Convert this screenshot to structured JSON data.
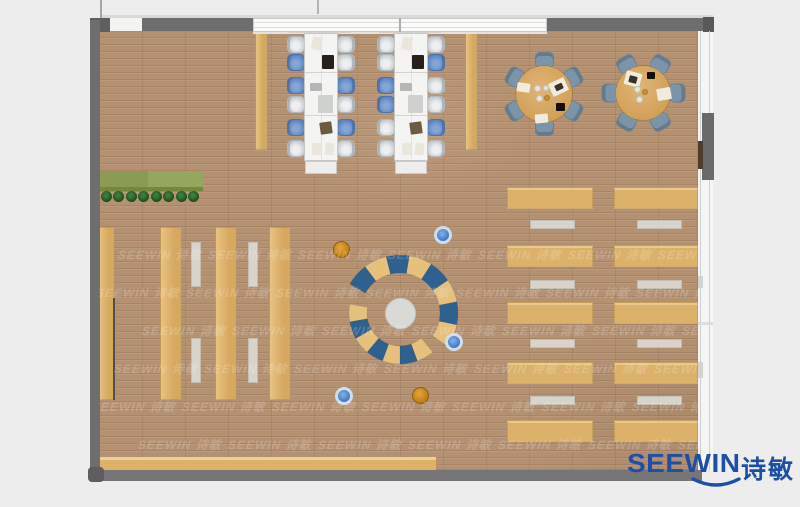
{
  "logo": {
    "latin": "SEEWIN",
    "cn": "诗敏",
    "color": "#1d4fa6"
  },
  "watermark": {
    "text": "SEEWIN 诗敏",
    "opacity": 0.42,
    "step": 90,
    "rows": [
      {
        "y": 246,
        "x0": 118
      },
      {
        "y": 284,
        "x0": 96
      },
      {
        "y": 322,
        "x0": 142
      },
      {
        "y": 360,
        "x0": 114
      },
      {
        "y": 398,
        "x0": 92
      },
      {
        "y": 436,
        "x0": 138
      }
    ]
  },
  "colors": {
    "wall": "#6e6e6e",
    "wall_dark": "#5f5f5f",
    "wall_bottom": "#767676",
    "seg_t": "#e6c07d",
    "seg_b": "#2e6190",
    "chair_gray": "#c9ced2",
    "chair_blue": "#5e87c2",
    "dining_chair": "#7b93a7",
    "table_tan": "#dcb26a",
    "logo_blue": "#1d4fa6"
  },
  "scene": {
    "room": {
      "x": 99,
      "y": 31,
      "w": 599,
      "h": 439
    },
    "rects": [
      {
        "n": "top-outer-line",
        "x": 100,
        "y": 15,
        "w": 613,
        "h": 3,
        "f": "#d9d9d9",
        "z": 40
      },
      {
        "n": "roof-line-1",
        "x": 100,
        "y": 0,
        "w": 2,
        "h": 18,
        "f": "#a5a5a5",
        "z": 40
      },
      {
        "n": "roof-line-2",
        "x": 317,
        "y": 0,
        "w": 2,
        "h": 14,
        "f": "#b3b3b3",
        "z": 40
      },
      {
        "n": "top-wall-cap-left",
        "x": 90,
        "y": 18,
        "w": 20,
        "h": 14,
        "f": "#5f5f5f",
        "z": 41
      },
      {
        "n": "door-gap-top",
        "x": 110,
        "y": 18,
        "w": 32,
        "h": 13,
        "f": "#f3f3f1",
        "z": 40
      },
      {
        "n": "top-wall-left",
        "x": 142,
        "y": 18,
        "w": 111,
        "h": 13,
        "f": "#6e6e6e",
        "z": 41
      },
      {
        "n": "window-band-top",
        "x": 253,
        "y": 18,
        "w": 294,
        "h": 14,
        "f": "#fbfbfa",
        "b": "1px solid #c9c9c9",
        "z": 40
      },
      {
        "n": "window-band-line1",
        "x": 253,
        "y": 22,
        "w": 294,
        "h": 1,
        "f": "#dddddc",
        "z": 41
      },
      {
        "n": "window-band-line2",
        "x": 253,
        "y": 27,
        "w": 294,
        "h": 1,
        "f": "#dddddc",
        "z": 41
      },
      {
        "n": "window-mullion",
        "x": 399,
        "y": 18,
        "w": 2,
        "h": 14,
        "f": "#ababab",
        "z": 42
      },
      {
        "n": "top-wall-right",
        "x": 547,
        "y": 18,
        "w": 156,
        "h": 13,
        "f": "#6e6e6e",
        "z": 41
      },
      {
        "n": "top-wall-cap-right",
        "x": 703,
        "y": 17,
        "w": 11,
        "h": 15,
        "f": "#595959",
        "z": 41
      },
      {
        "n": "left-wall",
        "x": 90,
        "y": 20,
        "w": 10,
        "h": 450,
        "f": "#6e6e6e",
        "z": 41
      },
      {
        "n": "bottom-wall",
        "x": 90,
        "y": 470,
        "w": 612,
        "h": 11,
        "f": "#767676",
        "z": 40
      },
      {
        "n": "corner-cap-bottom-left",
        "x": 88,
        "y": 467,
        "w": 16,
        "h": 15,
        "f": "#5e5e5e",
        "r": 4,
        "z": 41
      },
      {
        "n": "window-sill-top",
        "x": 253,
        "y": 31,
        "w": 294,
        "h": 3,
        "f": "#e3e2df",
        "z": 11
      },
      {
        "n": "right-window-wall",
        "x": 698,
        "y": 31,
        "w": 15,
        "h": 439,
        "f": "#f5f5f4",
        "z": 40
      },
      {
        "n": "right-window-line1",
        "x": 700,
        "y": 31,
        "w": 1,
        "h": 439,
        "f": "#cfcfcf",
        "z": 41
      },
      {
        "n": "right-window-line2",
        "x": 709,
        "y": 31,
        "w": 1,
        "h": 439,
        "f": "#cfcfcf",
        "z": 41
      },
      {
        "n": "right-wall-solid",
        "x": 702,
        "y": 113,
        "w": 12,
        "h": 67,
        "f": "#6a6a6a",
        "z": 42
      },
      {
        "n": "right-wall-door",
        "x": 698,
        "y": 141,
        "w": 5,
        "h": 28,
        "f": "#4e3d2c",
        "z": 43
      },
      {
        "n": "right-window-tab1",
        "x": 698,
        "y": 276,
        "w": 5,
        "h": 12,
        "f": "#d3d3d0",
        "z": 42
      },
      {
        "n": "right-window-tab2",
        "x": 698,
        "y": 362,
        "w": 5,
        "h": 16,
        "f": "#d3d3d0",
        "z": 42
      },
      {
        "n": "right-window-mullion1",
        "x": 698,
        "y": 322,
        "w": 15,
        "h": 3,
        "f": "#dcdcda",
        "z": 42
      },
      {
        "n": "planter-left",
        "x": 100,
        "y": 171,
        "w": 48,
        "h": 16,
        "f": "#8b9c52",
        "z": 10
      },
      {
        "n": "planter-right",
        "x": 148,
        "y": 171,
        "w": 55,
        "h": 16,
        "f": "#96a65c",
        "z": 10
      },
      {
        "n": "planter-shadow",
        "x": 100,
        "y": 187,
        "w": 103,
        "h": 4,
        "f": "#75863e",
        "z": 10
      },
      {
        "n": "book-stack-1",
        "x": 98,
        "y": 227,
        "w": 16,
        "h": 173,
        "f": "tan",
        "z": 10
      },
      {
        "n": "book-stack-2",
        "x": 160,
        "y": 227,
        "w": 21,
        "h": 173,
        "f": "tan",
        "z": 10
      },
      {
        "n": "book-stack-3",
        "x": 215,
        "y": 227,
        "w": 21,
        "h": 173,
        "f": "tan",
        "z": 10
      },
      {
        "n": "book-stack-4",
        "x": 269,
        "y": 227,
        "w": 21,
        "h": 173,
        "f": "tan",
        "z": 10
      },
      {
        "n": "stack-shadow-edge",
        "x": 113,
        "y": 298,
        "w": 2,
        "h": 102,
        "f": "#4f4f4f",
        "z": 11
      },
      {
        "n": "stack-bench-1a",
        "x": 191,
        "y": 242,
        "w": 10,
        "h": 45,
        "f": "bench",
        "z": 10
      },
      {
        "n": "stack-bench-1b",
        "x": 191,
        "y": 338,
        "w": 10,
        "h": 45,
        "f": "bench",
        "z": 10
      },
      {
        "n": "stack-bench-2a",
        "x": 248,
        "y": 242,
        "w": 10,
        "h": 45,
        "f": "bench",
        "z": 10
      },
      {
        "n": "stack-bench-2b",
        "x": 248,
        "y": 338,
        "w": 10,
        "h": 45,
        "f": "bench",
        "z": 10
      },
      {
        "n": "screen-panel-1",
        "x": 255,
        "y": 33,
        "w": 12,
        "h": 117,
        "f": "tan",
        "z": 10
      },
      {
        "n": "screen-panel-2",
        "x": 465,
        "y": 33,
        "w": 12,
        "h": 117,
        "f": "tan",
        "z": 10
      },
      {
        "n": "service-counter",
        "x": 99,
        "y": 457,
        "w": 338,
        "h": 13,
        "f": "counter",
        "z": 12
      },
      {
        "n": "ws-wall-panel-1",
        "x": 289,
        "y": 28,
        "w": 62,
        "h": 5,
        "f": "#d2d2d0",
        "z": 12
      },
      {
        "n": "ws-wall-panel-2",
        "x": 379,
        "y": 28,
        "w": 62,
        "h": 5,
        "f": "#d2d2d0",
        "z": 12
      }
    ],
    "trees": {
      "y": 196,
      "r": 5.5,
      "xs": [
        106,
        118.5,
        131,
        143.5,
        156,
        168.5,
        181,
        193.5
      ]
    },
    "workstations": {
      "desk_y": 33,
      "desk_h": 128,
      "desk_w": 34,
      "chair_ys": [
        36,
        54,
        77,
        96,
        119,
        140
      ],
      "groups": [
        {
          "x": 304,
          "left": [
            "g",
            "b",
            "b",
            "g",
            "b",
            "g"
          ],
          "right": [
            "g",
            "g",
            "b",
            "g",
            "b",
            "g"
          ]
        },
        {
          "x": 394,
          "left": [
            "g",
            "g",
            "b",
            "b",
            "g",
            "g"
          ],
          "right": [
            "g",
            "b",
            "g",
            "g",
            "b",
            "g"
          ]
        }
      ],
      "items": [
        {
          "dx": 8,
          "dy": 4,
          "w": 10,
          "h": 13,
          "f": "#eae6db",
          "rot": 12
        },
        {
          "dx": 18,
          "dy": 22,
          "w": 12,
          "h": 14,
          "f": "#27201a",
          "rot": 0
        },
        {
          "dx": 6,
          "dy": 50,
          "w": 12,
          "h": 8,
          "f": "#b4b8b4",
          "rot": 0
        },
        {
          "dx": 14,
          "dy": 62,
          "w": 15,
          "h": 18,
          "f": "#ced1ce",
          "rot": 0
        },
        {
          "dx": 16,
          "dy": 89,
          "w": 12,
          "h": 12,
          "f": "#6b5b41",
          "rot": -8
        },
        {
          "dx": 8,
          "dy": 110,
          "w": 9,
          "h": 12,
          "f": "#eae6db",
          "rot": 0
        },
        {
          "dx": 21,
          "dy": 110,
          "w": 9,
          "h": 12,
          "f": "#eae6db",
          "rot": 6
        }
      ]
    },
    "round_tables": [
      {
        "cx": 544,
        "cy": 94,
        "r": 28,
        "angles": [
          90,
          150,
          210,
          270,
          330,
          30
        ],
        "items": [
          {
            "t": "r",
            "x": 550,
            "y": 80,
            "w": 17,
            "h": 14,
            "f": "#efecdf",
            "rot": -25
          },
          {
            "t": "r",
            "x": 555,
            "y": 84,
            "w": 8,
            "h": 6,
            "f": "#3a3226",
            "rot": -25
          },
          {
            "t": "r",
            "x": 517,
            "y": 83,
            "w": 13,
            "h": 9,
            "f": "#efecdf",
            "rot": 8
          },
          {
            "t": "c",
            "x": 537,
            "y": 88,
            "r": 3.5,
            "f": "#e7e4d8"
          },
          {
            "t": "c",
            "x": 546,
            "y": 88,
            "r": 3,
            "f": "#e7e4d8"
          },
          {
            "t": "c",
            "x": 539,
            "y": 98,
            "r": 3.5,
            "f": "#e7e4d8"
          },
          {
            "t": "c",
            "x": 547,
            "y": 98,
            "r": 3,
            "f": "#c98f2f"
          },
          {
            "t": "r",
            "x": 556,
            "y": 103,
            "w": 9,
            "h": 8,
            "f": "#150e08",
            "rot": 0
          },
          {
            "t": "r",
            "x": 535,
            "y": 114,
            "w": 13,
            "h": 9,
            "f": "#efecdf",
            "rot": -5
          }
        ]
      },
      {
        "cx": 643,
        "cy": 93,
        "r": 27,
        "angles": [
          0,
          60,
          120,
          180,
          240,
          300
        ],
        "items": [
          {
            "t": "r",
            "x": 625,
            "y": 72,
            "w": 16,
            "h": 14,
            "f": "#efecdf",
            "rot": 15
          },
          {
            "t": "r",
            "x": 629,
            "y": 76,
            "w": 8,
            "h": 7,
            "f": "#3a3226",
            "rot": 15
          },
          {
            "t": "r",
            "x": 647,
            "y": 72,
            "w": 8,
            "h": 7,
            "f": "#150e08",
            "rot": 0
          },
          {
            "t": "c",
            "x": 637,
            "y": 89,
            "r": 3.5,
            "f": "#e7e4d8"
          },
          {
            "t": "c",
            "x": 645,
            "y": 92,
            "r": 3,
            "f": "#c98f2f"
          },
          {
            "t": "c",
            "x": 639,
            "y": 99,
            "r": 3.5,
            "f": "#e7e4d8"
          },
          {
            "t": "r",
            "x": 657,
            "y": 88,
            "w": 14,
            "h": 12,
            "f": "#efecdf",
            "rot": -10
          }
        ]
      }
    ],
    "reading": {
      "cols": [
        {
          "tx": 507,
          "tw": 86,
          "bx": 530
        },
        {
          "tx": 614,
          "tw": 84,
          "bx": 637
        }
      ],
      "rows": [
        187,
        245,
        302,
        362,
        420
      ],
      "th": 22,
      "bench_rows": [
        220,
        280,
        339,
        396
      ],
      "bw": 45,
      "bh": 9
    },
    "lounge": {
      "cx": 400,
      "cy": 313,
      "core_r": 15.5,
      "arcs": [
        {
          "r_in": 33,
          "r_out": 51,
          "from": 170,
          "to": 310,
          "seq": [
            "t",
            "b",
            "t",
            "b",
            "t",
            "b",
            "t"
          ]
        },
        {
          "r_in": 40,
          "r_out": 58,
          "from": 150,
          "to": -35,
          "seq": [
            "b",
            "t",
            "b",
            "t",
            "b",
            "t",
            "b",
            "t"
          ]
        }
      ],
      "stools": [
        {
          "x": 443,
          "y": 235,
          "c": "blue"
        },
        {
          "x": 342,
          "y": 250,
          "c": "orange"
        },
        {
          "x": 454,
          "y": 342,
          "c": "blue"
        },
        {
          "x": 344,
          "y": 396,
          "c": "blue"
        },
        {
          "x": 421,
          "y": 396,
          "c": "orange"
        }
      ]
    }
  }
}
